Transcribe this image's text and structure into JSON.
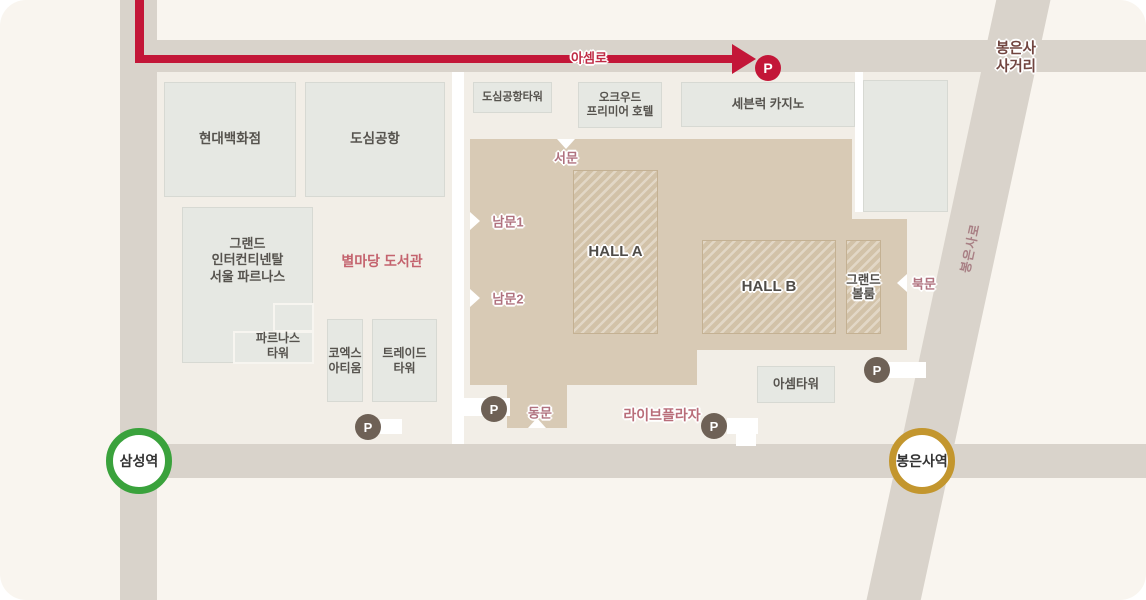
{
  "parking": {
    "letter": "P"
  },
  "stations": {
    "samseong": "삼성역",
    "bongeunsa": "봉은사역"
  },
  "roads": {
    "asem_ro": "아셈로",
    "bongeunsa_ro": "봉은사로",
    "intersection": {
      "line1": "봉은사",
      "line2": "사거리"
    }
  },
  "areas": {
    "byeolmadang_library": "별마당 도서관",
    "live_plaza": "라이브플라자"
  },
  "buildings": {
    "hyundai_dept": "현대백화점",
    "city_airport": "도심공항",
    "city_airport_tower": "도심공항타워",
    "oakwood": {
      "line1": "오크우드",
      "line2": "프리미어 호텔"
    },
    "seven_luck": "세븐럭 카지노",
    "grand_ic": {
      "line1": "그랜드",
      "line2": "인터컨티넨탈",
      "line3": "서울 파르나스"
    },
    "parnas_tower": {
      "line1": "파르나스",
      "line2": "타워"
    },
    "coex_artium": {
      "line1": "코엑스",
      "line2": "아티움"
    },
    "trade_tower": {
      "line1": "트레이드",
      "line2": "타워"
    },
    "asem_tower": "아셈타워"
  },
  "coex": {
    "hall_a": "HALL A",
    "hall_b": "HALL B",
    "grand_ballroom": {
      "line1": "그랜드",
      "line2": "볼룸"
    },
    "gates": {
      "west": "서문",
      "south1": "남문1",
      "south2": "남문2",
      "east": "동문",
      "north": "북문"
    }
  },
  "colors": {
    "route_red": "#c31638",
    "parking_dark": "#6e6156",
    "station_green": "#3aa23c",
    "station_gold": "#c3962e",
    "coex_tan": "#d8cab5",
    "road_gray": "#d9d3cb",
    "gate_rose": "#b0727f",
    "intersection_maroon": "#714540"
  }
}
